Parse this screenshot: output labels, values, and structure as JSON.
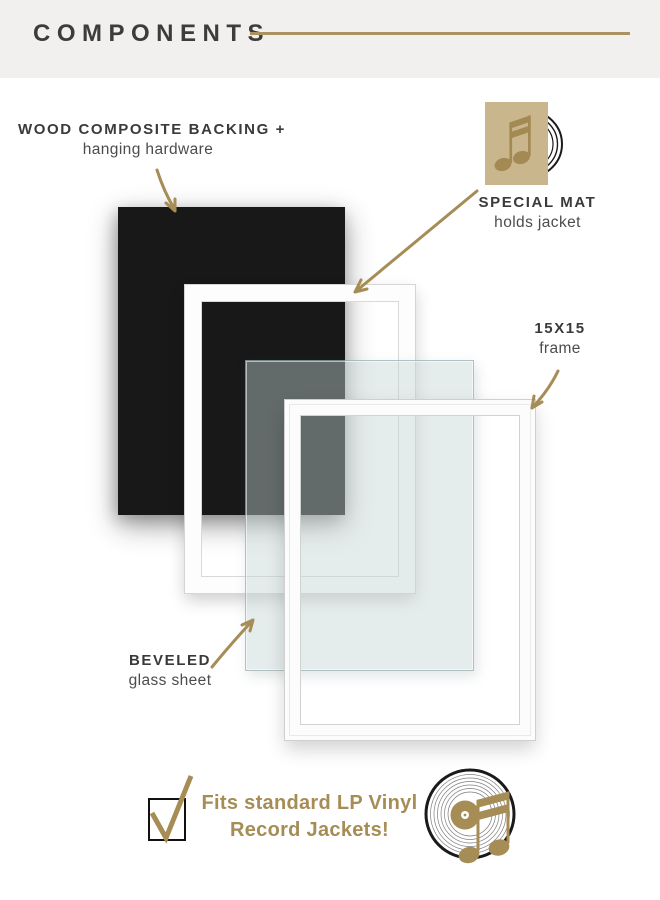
{
  "header": {
    "title": "COMPONENTS"
  },
  "callouts": {
    "backing": {
      "title": "WOOD COMPOSITE BACKING +",
      "subtitle": "hanging hardware"
    },
    "mat": {
      "title": "SPECIAL MAT",
      "subtitle": "holds jacket"
    },
    "frame": {
      "title": "15X15",
      "subtitle": "frame"
    },
    "glass": {
      "title": "BEVELED",
      "subtitle": "glass sheet"
    }
  },
  "footer": {
    "line1": "Fits standard LP Vinyl",
    "line2": "Record Jackets!"
  },
  "icons": {
    "jacket": "record-jacket-with-music-note-and-vinyl-icon",
    "record": "vinyl-record-with-music-note-icon",
    "checkbox": "checked-checkbox-icon"
  },
  "colors": {
    "gold_accent": "#a68c55",
    "tan_jacket": "#c9b68d",
    "ink_text": "#3a3a3a",
    "backing_black": "#181818",
    "header_band": "#f1f0ee",
    "glass_tint": "rgba(196,211,212,0.44)"
  }
}
